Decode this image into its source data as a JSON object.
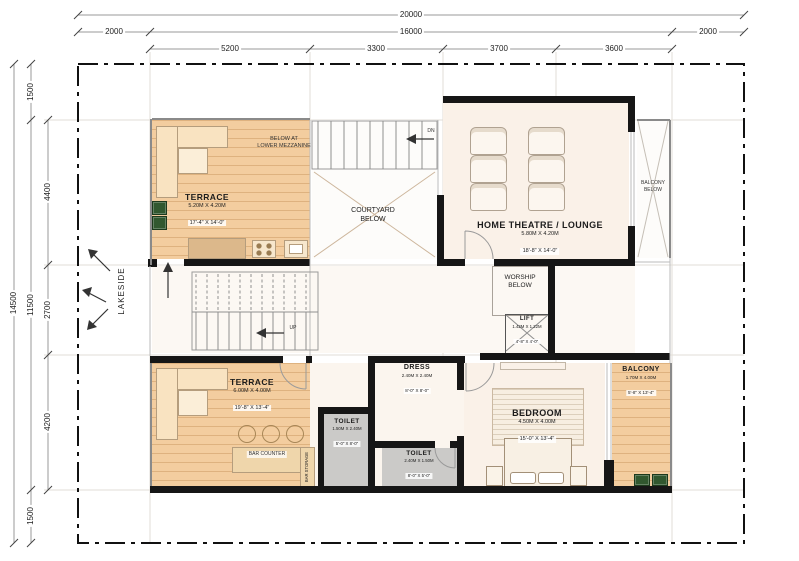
{
  "drawing": {
    "dims_top": {
      "overall": "20000",
      "row2": [
        "2000",
        "16000",
        "2000"
      ],
      "segments": [
        "5200",
        "3300",
        "3700",
        "3600"
      ]
    },
    "dims_left": {
      "overall": "14500",
      "row2": [
        "1500",
        "11500",
        "1500"
      ],
      "segments": [
        "4400",
        "2700",
        "4200"
      ]
    },
    "site_label": "LAKESIDE",
    "notes": {
      "below_mezz_1": "BELOW AT",
      "below_mezz_2": "LOWER MEZZANINE",
      "courtyard_1": "COURTYARD",
      "courtyard_2": "BELOW",
      "balcony_below_1": "BALCONY",
      "balcony_below_2": "BELOW",
      "worship_1": "WORSHIP",
      "worship_2": "BELOW",
      "bar_counter": "BAR COUNTER",
      "bar_storage": "BAR STORAGE",
      "stair_up": "UP",
      "stair_dn": "DN"
    },
    "rooms": {
      "terrace_top": {
        "name": "TERRACE",
        "metric": "5.20M  X  4.20M",
        "imperial": "17'-4\"  X  14'-0\""
      },
      "home_theatre": {
        "name": "HOME THEATRE / LOUNGE",
        "metric": "5.80M  X  4.20M",
        "imperial": "18'-8\"  X  14'-0\""
      },
      "lift": {
        "name": "LIFT",
        "metric": "1.42M X 1.22M",
        "imperial": "4'-8\" X 4'-0\""
      },
      "dress": {
        "name": "DRESS",
        "metric": "2.40M  X  2.40M",
        "imperial": "8'-0\"  X  8'-0\""
      },
      "terrace_bottom": {
        "name": "TERRACE",
        "metric": "6.00M  X  4.00M",
        "imperial": "19'-8\"  X  13'-4\""
      },
      "toilet_left": {
        "name": "TOILET",
        "metric": "1.50M X 2.40M",
        "imperial": "5'-0\" X 8'-0\""
      },
      "toilet_right": {
        "name": "TOILET",
        "metric": "2.40M X 1.50M",
        "imperial": "8'-0\" X 5'-0\""
      },
      "bedroom": {
        "name": "BEDROOM",
        "metric": "4.50M  X  4.00M",
        "imperial": "15'-0\"  X  13'-4\""
      },
      "balcony": {
        "name": "BALCONY",
        "metric": "1.70M X 4.00M",
        "imperial": "5'-8\" X 13'-4\""
      }
    },
    "colors": {
      "wall": "#161616",
      "wood_floor": "#f3cd9f",
      "cream_floor": "#faf1e8",
      "toilet_floor": "#cbcac8",
      "planter_green": "#31582f",
      "dim_line": "#999999"
    }
  }
}
